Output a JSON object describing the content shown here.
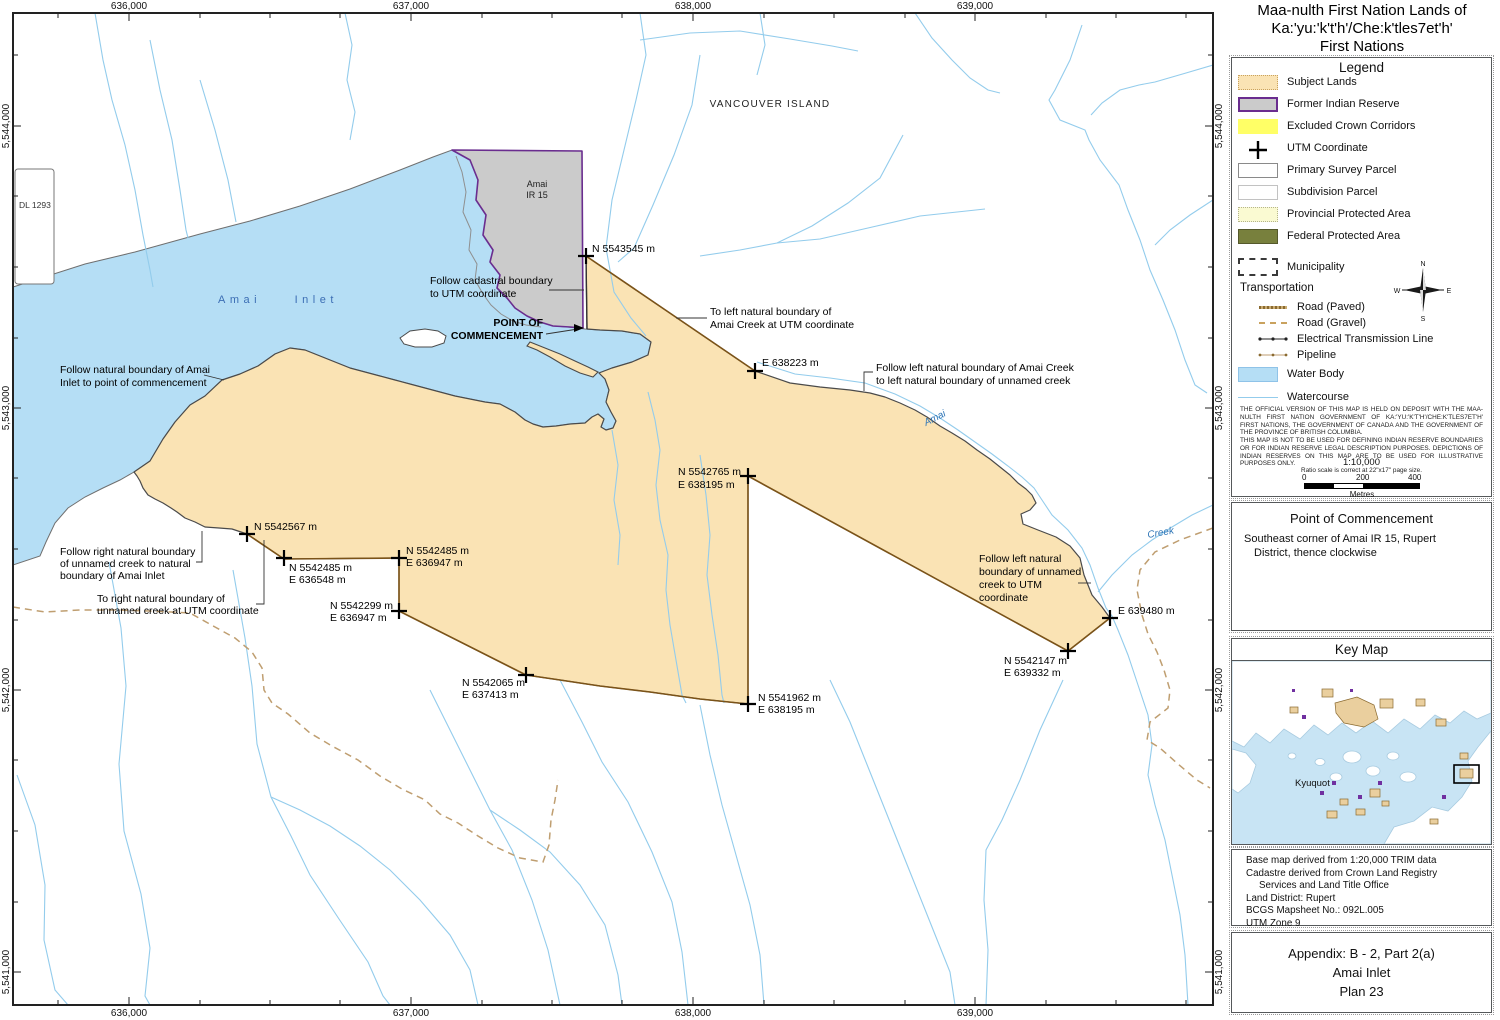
{
  "title": {
    "line1": "Maa-nulth First Nation Lands of",
    "line2": "Ka:'yu:'k't'h'/Che:k'tles7et'h'",
    "line3": "First Nations"
  },
  "legend": {
    "title": "Legend",
    "items": [
      {
        "label": "Subject Lands",
        "swatch": "subject",
        "color": "#FAE3B4"
      },
      {
        "label": "Former Indian Reserve",
        "swatch": "reserve",
        "color": "#CBCBCB"
      },
      {
        "label": "Excluded Crown Corridors",
        "swatch": "excluded",
        "color": "#FFFF66"
      },
      {
        "label": "UTM Coordinate",
        "swatch": "utm-cross",
        "color": "#000000"
      },
      {
        "label": "Primary Survey Parcel",
        "swatch": "primary",
        "color": "#FFFFFF"
      },
      {
        "label": "Subdivision Parcel",
        "swatch": "subdivision",
        "color": "#FFFFFF"
      },
      {
        "label": "Provincial Protected Area",
        "swatch": "provincial",
        "color": "#FAFAD2"
      },
      {
        "label": "Federal Protected Area",
        "swatch": "federal",
        "color": "#78803D"
      },
      {
        "label": "Municipality",
        "swatch": "municipality",
        "color": "#FFFFFF"
      }
    ],
    "transportation": {
      "heading": "Transportation",
      "items": [
        {
          "label": "Road (Paved)",
          "glyph": "road-paved"
        },
        {
          "label": "Road (Gravel)",
          "glyph": "road-gravel"
        },
        {
          "label": "Electrical Transmission Line",
          "glyph": "transmission-line"
        },
        {
          "label": "Pipeline",
          "glyph": "pipeline"
        }
      ]
    },
    "water_items": [
      {
        "label": "Water Body",
        "swatch": "water-body",
        "color": "#B5DEF5"
      },
      {
        "label": "Watercourse",
        "glyph": "watercourse",
        "color": "#93CCEC"
      }
    ],
    "disclaimer1": "THE OFFICIAL VERSION OF THIS MAP IS HELD ON DEPOSIT WITH THE MAA-NULTH FIRST NATION GOVERNMENT OF KA:'YU:'K'T'H'/CHE:K'TLES7ET'H' FIRST NATIONS, THE GOVERNMENT OF CANADA AND THE GOVERNMENT OF THE PROVINCE OF BRITISH COLUMBIA.",
    "disclaimer2": "THIS MAP IS NOT TO BE USED FOR DEFINING INDIAN RESERVE BOUNDARIES OR FOR INDIAN RESERVE LEGAL DESCRIPTION PURPOSES.  DEPICTIONS OF INDIAN RESERVES ON THIS MAP ARE TO BE USED FOR ILLUSTRATIVE PURPOSES ONLY.",
    "scale": {
      "ratio": "1:10,000",
      "note": "Ratio scale is correct at 22\"x17\" page size.",
      "tick0": "0",
      "tick200": "200",
      "tick400": "400",
      "unit": "Metres"
    },
    "compass": {
      "n": "N",
      "e": "E",
      "s": "S",
      "w": "W"
    }
  },
  "poc_box": {
    "title": "Point of Commencement",
    "line1": "Southeast corner of Amai IR 15, Rupert",
    "line2": "District, thence clockwise"
  },
  "key_map": {
    "title": "Key Map",
    "place": "Kyuquot"
  },
  "base_info": {
    "line1": "Base map derived from 1:20,000 TRIM data",
    "line2": "Cadastre derived from Crown Land Registry",
    "line3": "Services and Land Title Office",
    "line4": "Land District: Rupert",
    "line5": "BCGS Mapsheet No.: 092L.005",
    "line6": "UTM Zone 9"
  },
  "appendix": {
    "line1": "Appendix:  B - 2, Part 2(a)",
    "line2": "Amai Inlet",
    "line3": "Plan 23"
  },
  "map": {
    "axis": {
      "top": [
        "636,000",
        "637,000",
        "638,000",
        "639,000"
      ],
      "bottom": [
        "636,000",
        "637,000",
        "638,000",
        "639,000"
      ],
      "left": [
        "5,544,000",
        "5,543,000",
        "5,542,000",
        "5,541,000"
      ],
      "right": [
        "5,544,000",
        "5,543,000",
        "5,542,000",
        "5,541,000"
      ]
    },
    "places": {
      "vancouver_island": "VANCOUVER ISLAND",
      "amai_inlet": "Amai Inlet",
      "amai": "Amai",
      "creek": "Creek",
      "dl": "DL 1293",
      "ir_l1": "Amai",
      "ir_l2": "IR 15",
      "poc_l1": "POINT OF",
      "poc_l2": "COMMENCEMENT"
    },
    "utm": {
      "n5543545": {
        "l1": "N 5543545 m"
      },
      "e638223": {
        "l1": "E 638223 m"
      },
      "n5542765": {
        "l1": "N 5542765 m",
        "l2": "E  638195 m"
      },
      "n5542567": {
        "l1": "N 5542567 m"
      },
      "n5542485a": {
        "l1": "N 5542485 m",
        "l2": "E  636548 m"
      },
      "n5542485b": {
        "l1": "N 5542485 m",
        "l2": "E  636947 m"
      },
      "n5542299": {
        "l1": "N 5542299 m",
        "l2": "E  636947 m"
      },
      "n5542065": {
        "l1": "N 5542065 m",
        "l2": "E  637413 m"
      },
      "n5541962": {
        "l1": "N 5541962 m",
        "l2": "E  638195 m"
      },
      "e639480": {
        "l1": "E 639480 m"
      },
      "n5542147": {
        "l1": "N 5542147 m",
        "l2": "E  639332 m"
      }
    },
    "annotations": {
      "cadastral": {
        "l1": "Follow cadastral boundary",
        "l2": "to UTM coordinate"
      },
      "to_left_amai": {
        "l1": "To left natural boundary of",
        "l2": "Amai Creek at UTM coordinate"
      },
      "follow_inlet": {
        "l1": "Follow natural boundary of Amai",
        "l2": "Inlet to point of commencement"
      },
      "follow_right_creek": {
        "l1": "Follow right natural boundary",
        "l2": "of unnamed creek to natural",
        "l3": "boundary of Amai Inlet"
      },
      "to_right_creek": {
        "l1": "To right natural boundary of",
        "l2": "unnamed creek at UTM coordinate"
      },
      "follow_left_amai": {
        "l1": "Follow left natural boundary of Amai Creek",
        "l2": "to left natural boundary of unnamed creek"
      },
      "follow_left_unnamed": {
        "l1": "Follow left natural",
        "l2": "boundary of unnamed",
        "l3": "creek to UTM",
        "l4": "coordinate"
      }
    }
  },
  "colors": {
    "subject": "#FAE3B4",
    "reserve_fill": "#CBCBCB",
    "reserve_border": "#6A2D8F",
    "excluded": "#FFFF66",
    "provincial": "#FAFAD2",
    "federal": "#78803D",
    "water": "#B5DEF5",
    "watercourse": "#93CCEC",
    "road_gravel": "#BF9E70",
    "survey_line": "#7B5318"
  }
}
